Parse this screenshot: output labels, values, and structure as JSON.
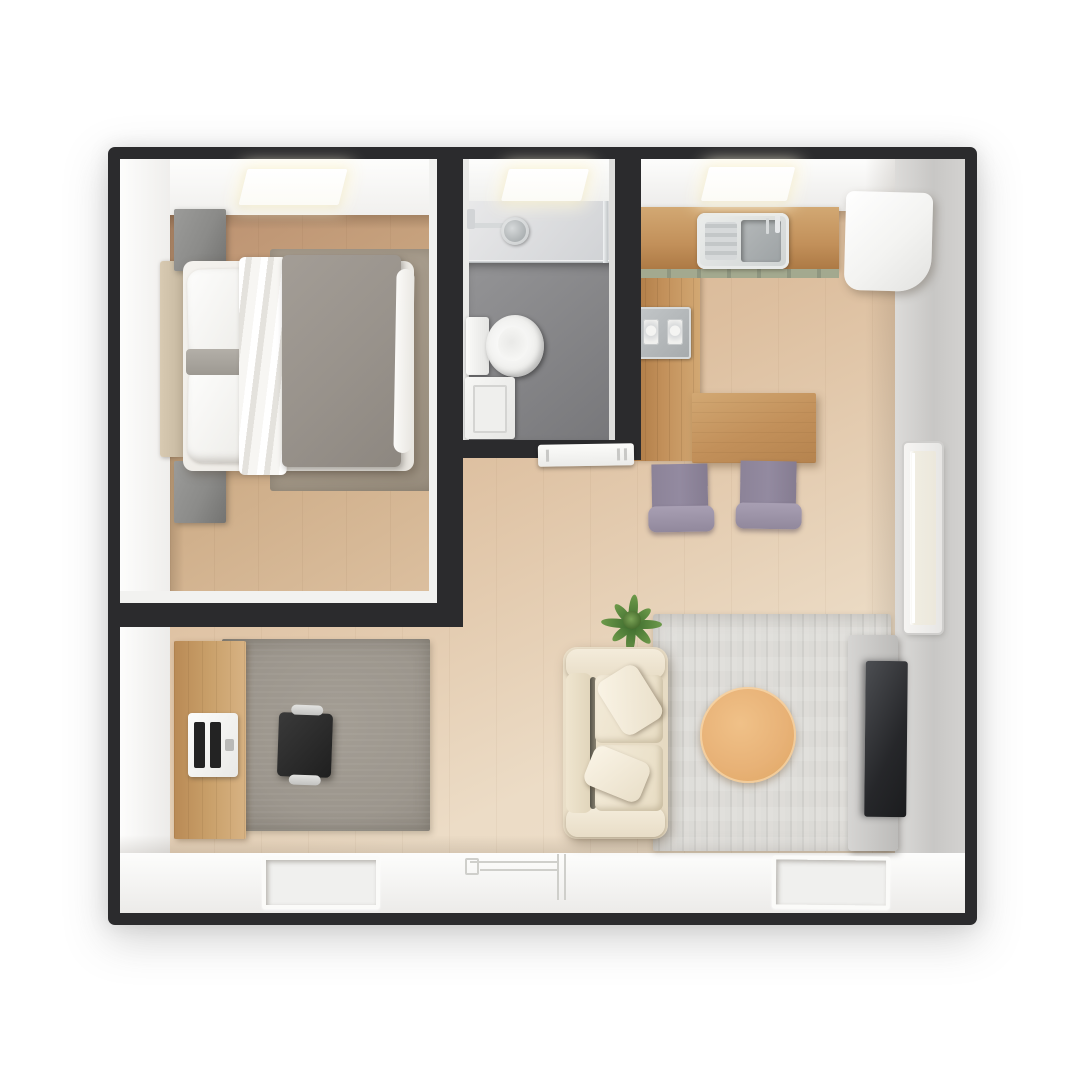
{
  "scene": {
    "type": "3d-rendered-floor-plan-top-view",
    "label": "Studio apartment floor plan, top-down 3D render",
    "rooms": [
      "bedroom",
      "bathroom",
      "kitchen-dining",
      "living-area",
      "home-office",
      "entry"
    ]
  },
  "objects": {
    "bedroom": [
      "double-bed",
      "white-pillows",
      "gray-duvet",
      "sheet-fold",
      "headboard",
      "nightstand-top",
      "nightstand-bottom",
      "bedside-rug",
      "skylight"
    ],
    "bathroom": [
      "toilet",
      "shower-area",
      "shower-head",
      "glass-partition",
      "low-cabinet",
      "skylight"
    ],
    "kitchen_dining": [
      "wood-counter",
      "stainless-sink",
      "backsplash",
      "side-counter",
      "two-burner-cooktop",
      "refrigerator",
      "dining-table",
      "dining-chair-left",
      "dining-chair-right",
      "skylight"
    ],
    "living": [
      "cream-sofa",
      "throw-pillow-top",
      "throw-pillow-bottom",
      "potted-plant",
      "round-coffee-table",
      "striped-area-rug",
      "tv-stand",
      "tv",
      "window"
    ],
    "office": [
      "wood-desk",
      "laptop",
      "office-chair",
      "gray-rug"
    ],
    "entry": [
      "door-swing-outline",
      "floor-mat-left",
      "floor-mat-right"
    ]
  },
  "palette": {
    "wall-dark": "#2b2b2d",
    "wall-white": "#f6f5f3",
    "wall-gray-light": "#dcdbd9",
    "wall-gray": "#c8c7c5",
    "band-white-hi": "#fdfdfc",
    "band-white-lo": "#ecebe9",
    "floor-main-dark": "#cfa884",
    "floor-main-mid": "#ddbf9f",
    "floor-main-light": "#ecdcc6",
    "floor-bedroom-dark": "#bb9070",
    "floor-bedroom-light": "#dcc0a0",
    "floor-bath-dark": "#77777a",
    "floor-bath-light": "#949496",
    "shower-light": "#e9e9ea",
    "shower-dark": "#cfd1d4",
    "wood-dark": "#ad7a45",
    "wood-mid": "#c2905a",
    "wood-light": "#d2a873",
    "wood-desk": "#c9a06a",
    "rug-living-a": "#dbdad6",
    "rug-living-b": "#d0cfcb",
    "rug-office": "#9c968d",
    "rug-bedroom": "#a69b8b",
    "sofa-base": "#ece1cb",
    "sofa-light": "#f4ecdb",
    "duvet-dark": "#8d8780",
    "duvet-light": "#a39d96",
    "chair-back": "#938aa0",
    "chair-seat": "#a89fb3",
    "coffee-a": "#f0c188",
    "coffee-b": "#dfa661",
    "plant-dark": "#3c6a2d",
    "plant-light": "#6d9a4a",
    "tv-dark": "#26272a",
    "tv-light": "#4c4e52",
    "steel-light": "#d6d9da",
    "steel-dark": "#9ea3a5"
  }
}
